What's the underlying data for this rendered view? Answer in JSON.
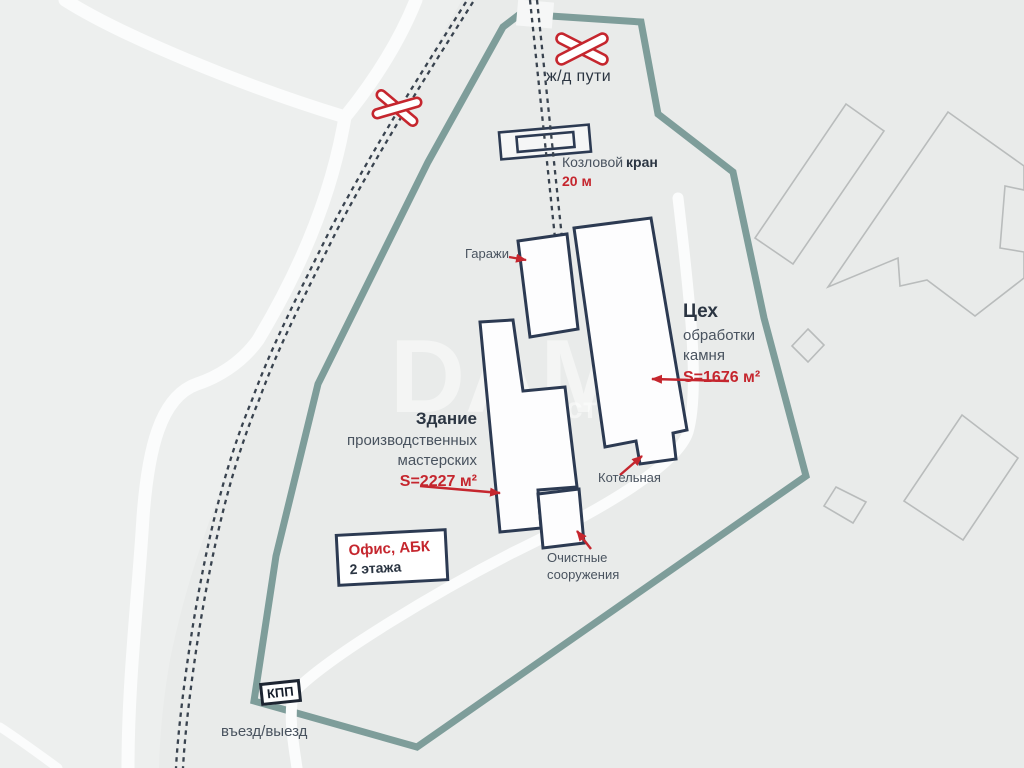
{
  "theme": {
    "bg": "#e9ebea",
    "bg-west": "#edefee",
    "road": "#fbfcfc",
    "boundary": "#7e9d9a",
    "navy": "#2c3a52",
    "ink": "#2b3542",
    "muted": "#49535f",
    "red": "#c5262e",
    "rail": "#39434f",
    "neighbor": "#b9bcbc",
    "building-fill": "#fdfdfe"
  },
  "labels": {
    "railway_tracks": "ж/д пути",
    "crane_regular": "Козловой",
    "crane_bold": "кран",
    "crane_length": "20 м",
    "garages": "Гаражи",
    "workshop": {
      "title": "Цех",
      "line2": "обработки",
      "line3": "камня",
      "area": "S=1676 м²"
    },
    "production": {
      "title": "Здание",
      "line2": "производственных",
      "line3": "мастерских",
      "area": "S=2227 м²"
    },
    "boiler": "Котельная",
    "treatment": {
      "line1": "Очистные",
      "line2": "сооружения"
    },
    "office": {
      "line1": "Офис, АБК",
      "line2": "2 этажа"
    },
    "checkpoint": "КПП",
    "entrance": "въезд/выезд",
    "watermark_big": "DАМ",
    "watermark_small": "ость"
  }
}
